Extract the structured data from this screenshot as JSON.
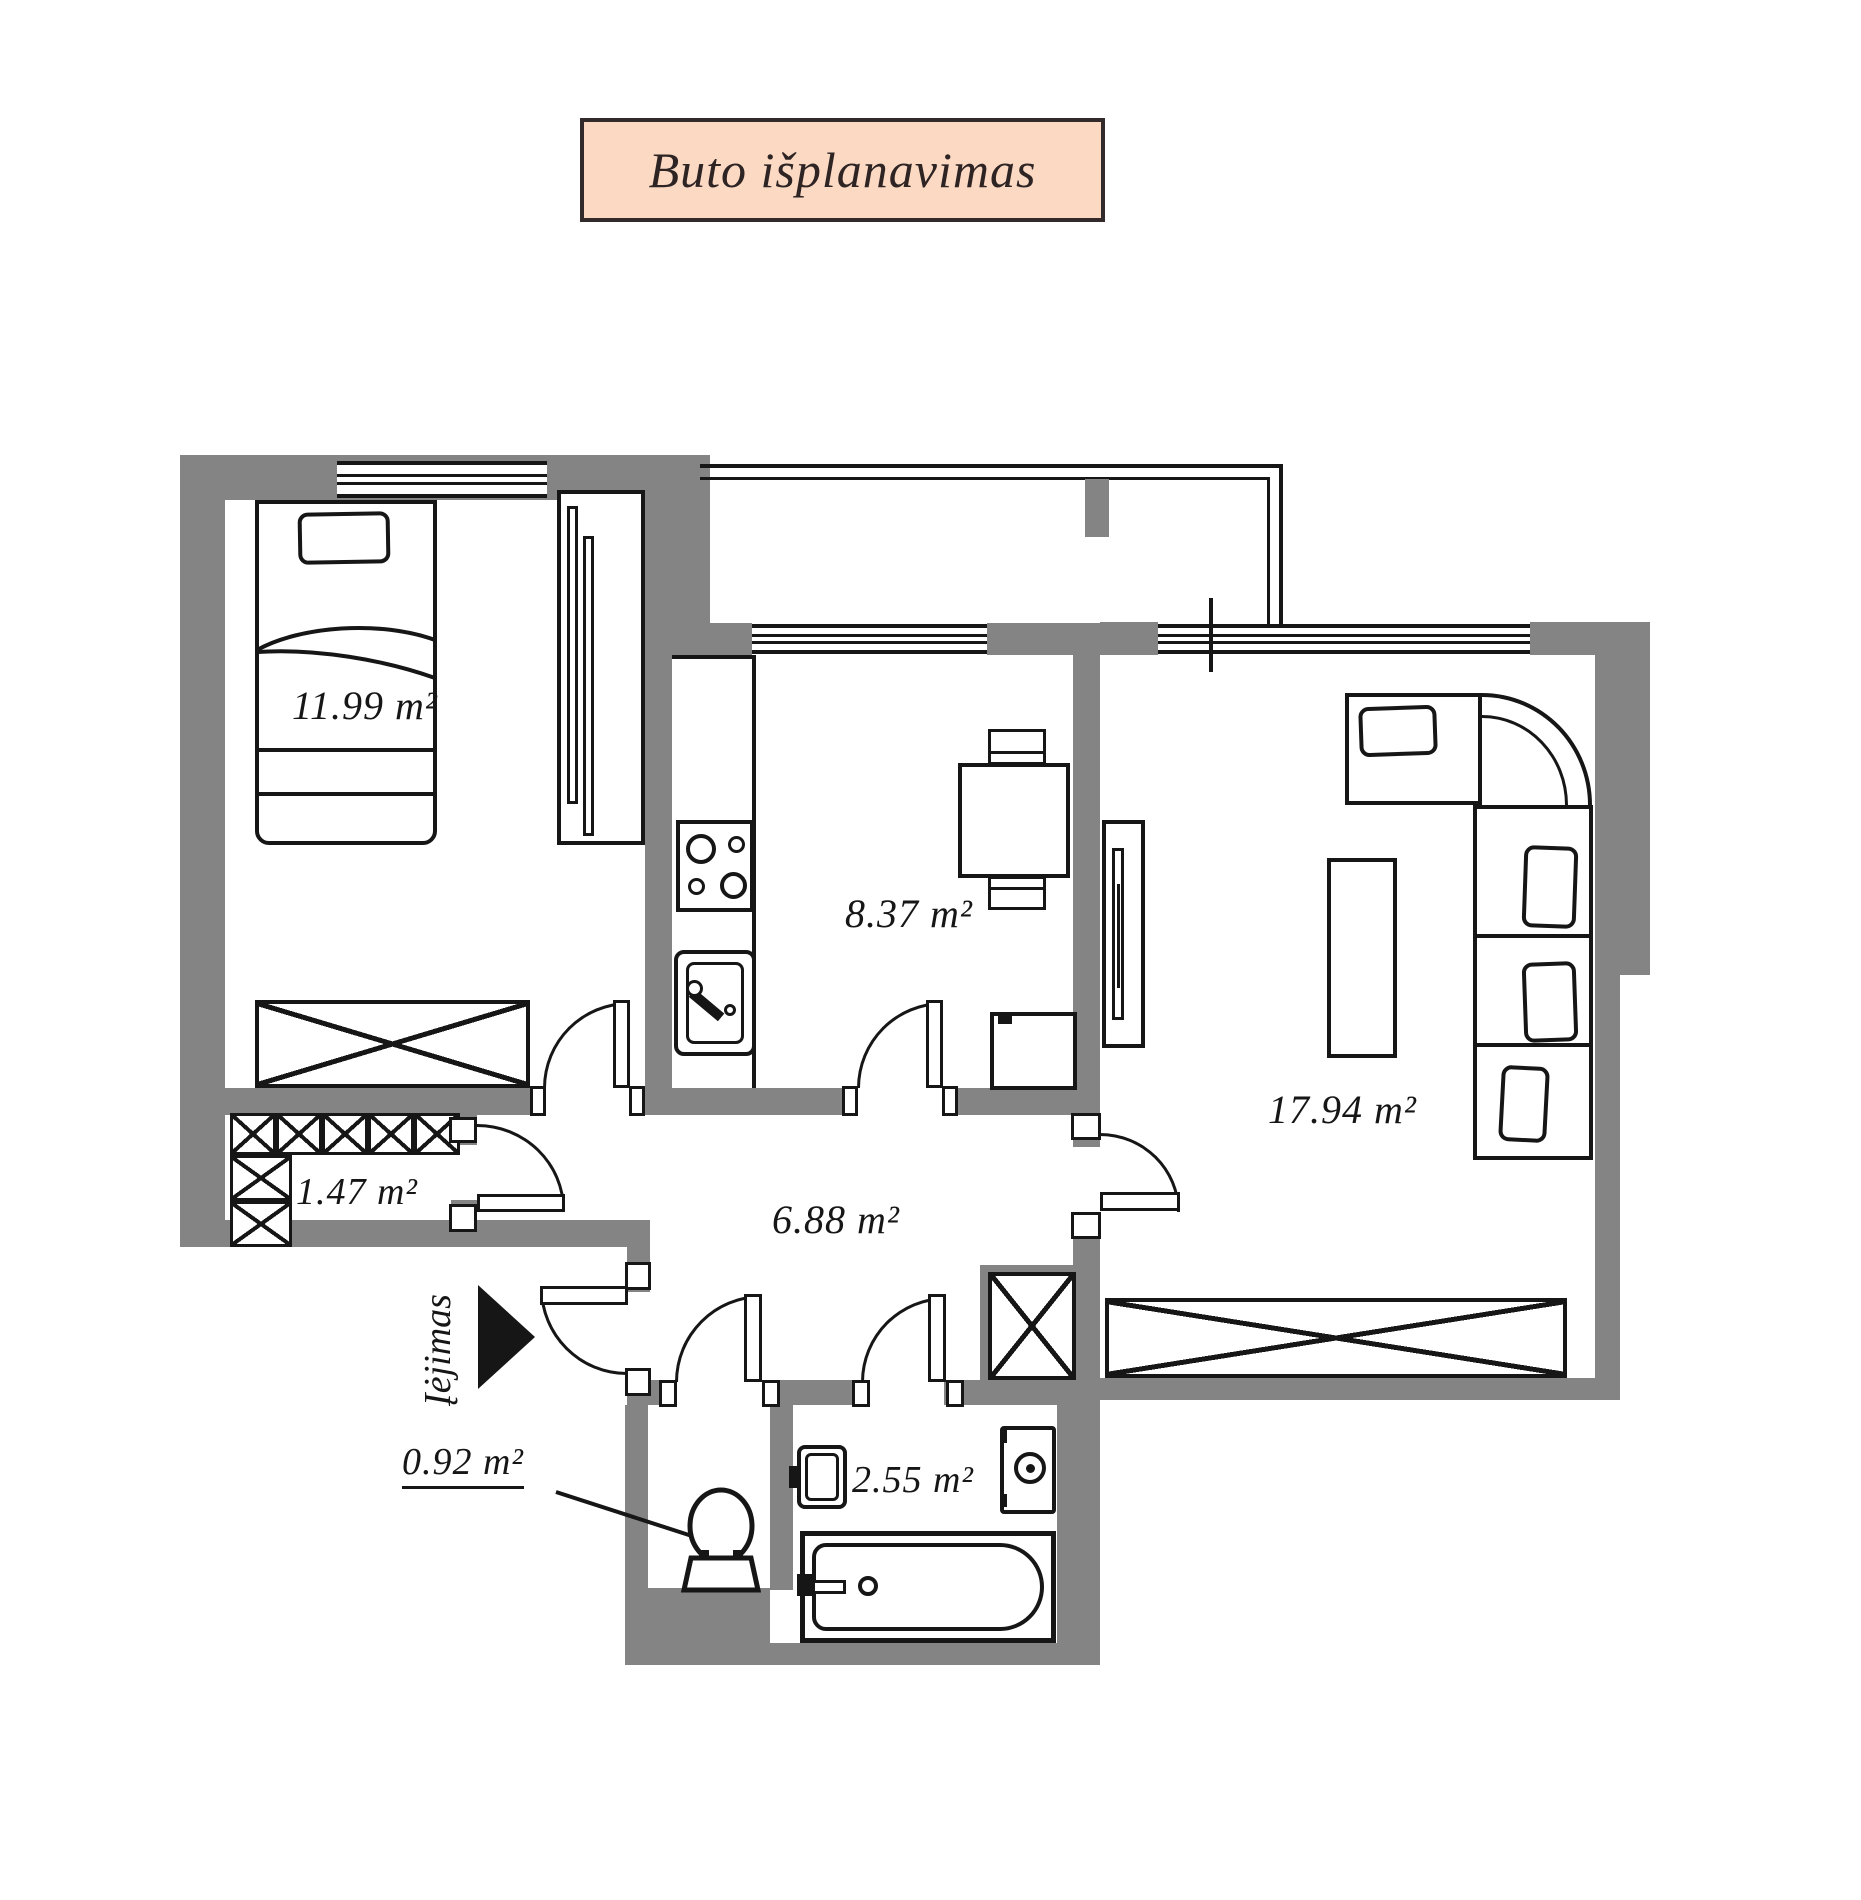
{
  "title": "Buto išplanavimas",
  "rooms": {
    "bedroom": {
      "area": "11.99 m²"
    },
    "kitchen": {
      "area": "8.37 m²"
    },
    "living": {
      "area": "17.94 m²"
    },
    "closet": {
      "area": "1.47 m²"
    },
    "hallway": {
      "area": "6.88 m²"
    },
    "wc": {
      "area": "0.92 m²"
    },
    "bathroom": {
      "area": "2.55 m²"
    }
  },
  "entrance_label": "Įėjimas",
  "colors": {
    "paper": "#ffffff",
    "wall": "#848484",
    "line": "#161616",
    "title_bg": "#fbd9c3",
    "title_border": "#332b2b",
    "title_text": "#2e2424"
  }
}
